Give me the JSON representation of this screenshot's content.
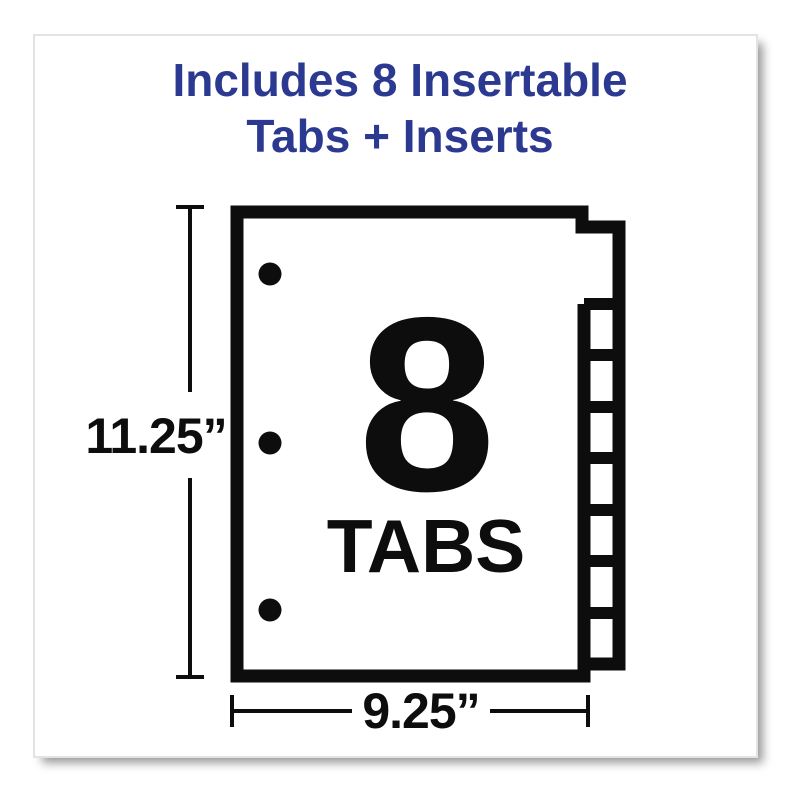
{
  "card": {
    "heading": {
      "line1": "Includes 8 Insertable",
      "line2": "Tabs + Inserts"
    }
  },
  "diagram": {
    "tab_count": "8",
    "tab_count_caption": "TABS",
    "height_dimension": "11.25”",
    "width_dimension": "9.25”",
    "tabs_total": 8,
    "punch_holes": 3
  },
  "colors": {
    "heading_blue": "#2b3990",
    "ink": "#0d0d0d",
    "card_border": "#e3e3e3"
  }
}
